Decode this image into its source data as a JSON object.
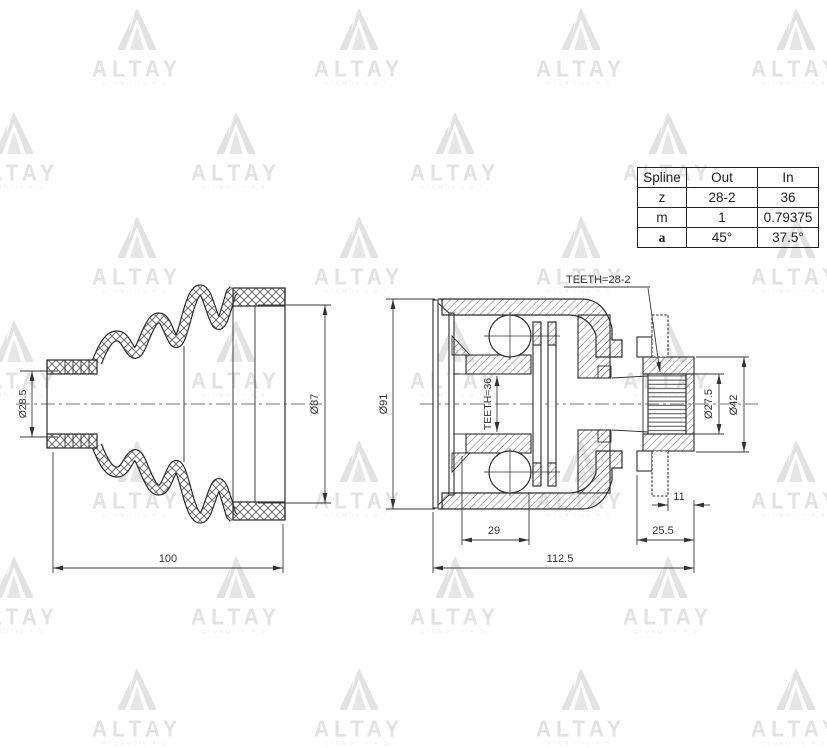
{
  "watermark": {
    "brand": "ALTAY",
    "subtext": "OTOMOTIV A.S.",
    "color": "#e2e2e2"
  },
  "spline_table": {
    "headers": [
      "Spline",
      "Out",
      "In"
    ],
    "rows": [
      [
        "z",
        "28-2",
        "36"
      ],
      [
        "m",
        "1",
        "0.79375"
      ],
      [
        "a",
        "45°",
        "37.5°"
      ]
    ]
  },
  "dimensions": {
    "boot": {
      "neck_diameter": "Ø28.5",
      "big_end_diameter": "Ø87",
      "length": "100"
    },
    "joint": {
      "housing_diameter": "Ø91",
      "inner_teeth": "TEETH=36",
      "outer_teeth": "TEETH=28-2",
      "race_width": "29",
      "overall_length": "112.5",
      "stub_length": "25.5",
      "step_length": "11",
      "spline_diameter": "Ø27.5",
      "collar_diameter": "Ø42"
    }
  },
  "colors": {
    "line": "#2b2b2b",
    "dim_line": "#3a3a3a",
    "watermark": "#e2e2e2"
  }
}
